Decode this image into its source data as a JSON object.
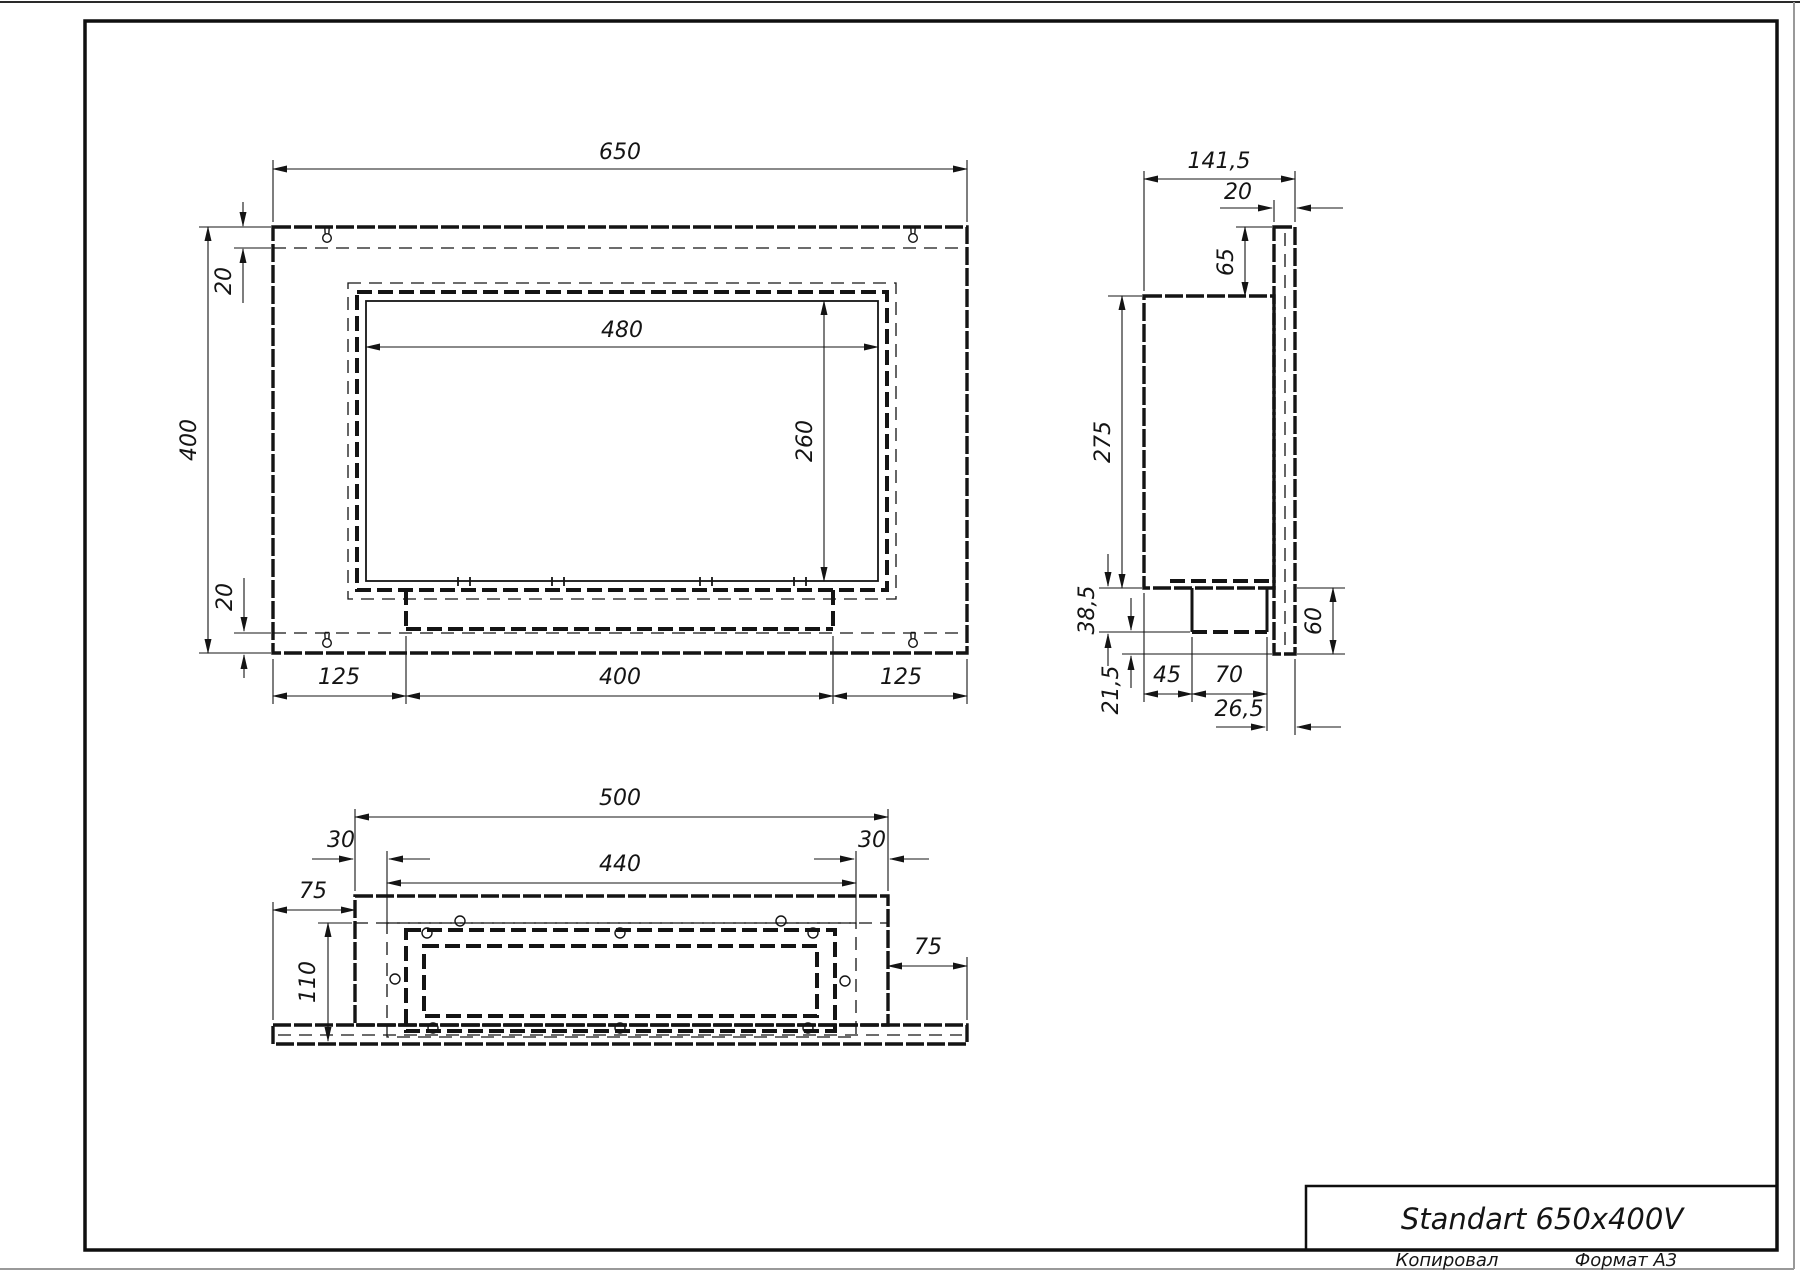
{
  "drawing": {
    "front": {
      "width": "650",
      "height": "400",
      "margin_top": "20",
      "margin_bottom": "20",
      "opening_width": "480",
      "opening_height": "260",
      "off_left": "125",
      "burner_width": "400",
      "off_right": "125"
    },
    "side": {
      "depth": "141,5",
      "plate": "20",
      "top_offset": "65",
      "body_height": "275",
      "tray_depth": "38,5",
      "below_offset": "21,5",
      "burner_left": "45",
      "burner_width": "70",
      "burner_right": "26,5",
      "bottom_flange": "60"
    },
    "bottom": {
      "body_width": "500",
      "rail_margin_left": "30",
      "rail_width": "440",
      "rail_margin_right": "30",
      "plate_margin_left": "75",
      "plate_margin_right": "75",
      "cavity_depth": "110"
    },
    "title_block": {
      "title": "Standart 650x400V",
      "copied_label": "Копировал",
      "format_label": "Формат А3"
    }
  }
}
